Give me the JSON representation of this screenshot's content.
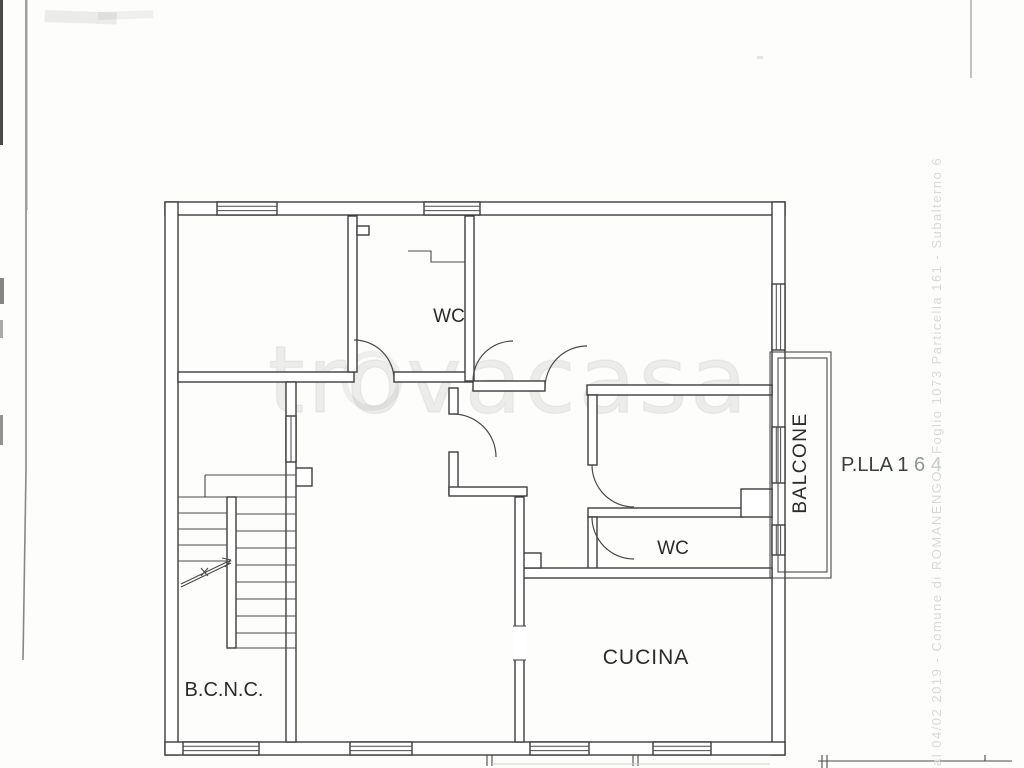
{
  "floorplan": {
    "rooms": {
      "wc_top": {
        "label": "WC"
      },
      "wc_lower": {
        "label": "WC"
      },
      "cucina": {
        "label": "CUCINA"
      },
      "bcnc": {
        "label": "B.C.N.C."
      },
      "balcone": {
        "label": "BALCONE"
      }
    },
    "parcel": {
      "prefix": "P.LLA 1",
      "digit_mid": "6",
      "digit_faint": "4"
    }
  },
  "watermark": {
    "text": "trovacasa"
  },
  "margin_note": {
    "text": "al 04/02 2019 - Comune di ROMANENGO - Foglio 1073 Particella 161 - Subalterno 6"
  },
  "colors": {
    "paper": "#fdfdfc",
    "line": "#3d3d3d",
    "label": "#2b2b2b",
    "watermark": "#8a8a8a",
    "parcel_mid": "#8d9696",
    "parcel_faint": "#c7cfcf",
    "margin_note_text": "#dad9d3"
  }
}
